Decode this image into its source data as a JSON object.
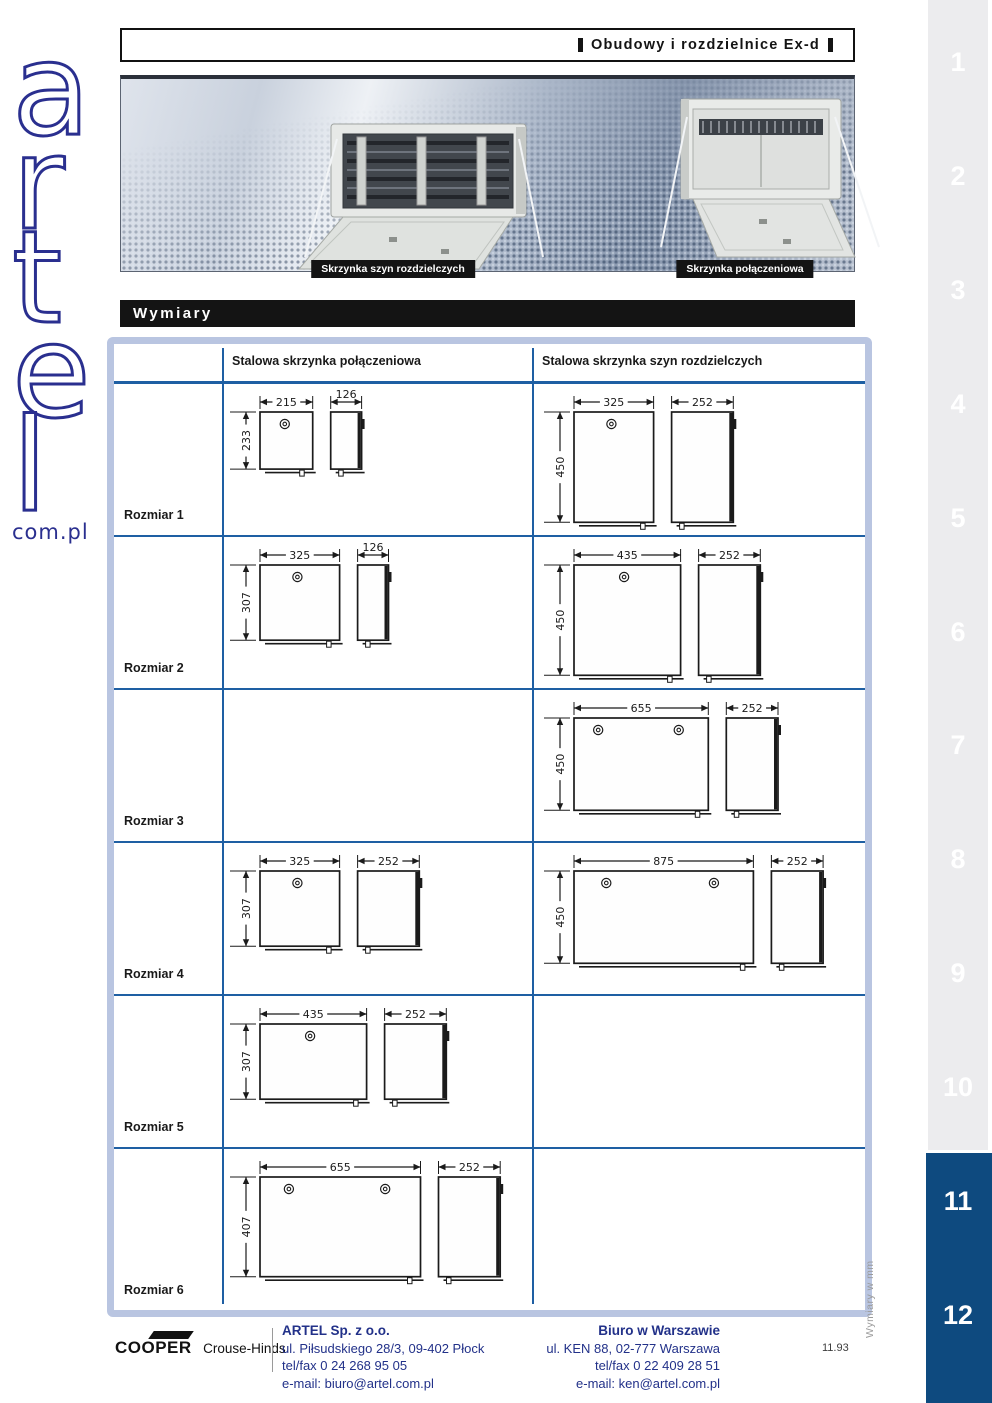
{
  "header": {
    "title": "Obudowy i rozdzielnice Ex-d"
  },
  "logo": {
    "letters": [
      "a",
      "r",
      "t",
      "e",
      "l"
    ],
    "domain": "com.pl"
  },
  "banner": {
    "labels": [
      "Skrzynka szyn rozdzielczych",
      "Skrzynka połączeniowa"
    ]
  },
  "section": {
    "title": "Wymiary"
  },
  "table": {
    "headers": [
      "Stalowa skrzynka połączeniowa",
      "Stalowa skrzynka szyn rozdzielczych"
    ],
    "units_note": "Wymiary w mm",
    "rows": [
      {
        "label": "Rozmiar 1",
        "left": {
          "width": 215,
          "height": 233,
          "depth": 126,
          "locks": 1
        },
        "right": {
          "width": 325,
          "height": 450,
          "depth": 252,
          "locks": 1
        }
      },
      {
        "label": "Rozmiar 2",
        "left": {
          "width": 325,
          "height": 307,
          "depth": 126,
          "locks": 1
        },
        "right": {
          "width": 435,
          "height": 450,
          "depth": 252,
          "locks": 1
        }
      },
      {
        "label": "Rozmiar 3",
        "left": null,
        "right": {
          "width": 655,
          "height": 450,
          "depth": 252,
          "locks": 2
        }
      },
      {
        "label": "Rozmiar 4",
        "left": {
          "width": 325,
          "height": 307,
          "depth": 252,
          "locks": 1
        },
        "right": {
          "width": 875,
          "height": 450,
          "depth": 252,
          "locks": 2
        }
      },
      {
        "label": "Rozmiar 5",
        "left": {
          "width": 435,
          "height": 307,
          "depth": 252,
          "locks": 1
        },
        "right": null
      },
      {
        "label": "Rozmiar 6",
        "left": {
          "width": 655,
          "height": 407,
          "depth": 252,
          "locks": 2
        },
        "right": null
      }
    ]
  },
  "sidebar": {
    "tabs": [
      {
        "label": "1",
        "active": false
      },
      {
        "label": "2",
        "active": false
      },
      {
        "label": "3",
        "active": false
      },
      {
        "label": "4",
        "active": false
      },
      {
        "label": "5",
        "active": false
      },
      {
        "label": "6",
        "active": false
      },
      {
        "label": "7",
        "active": false
      },
      {
        "label": "8",
        "active": false
      },
      {
        "label": "9",
        "active": false
      },
      {
        "label": "10",
        "active": false
      },
      {
        "label": "11",
        "active": true
      },
      {
        "label": "12",
        "active": true
      }
    ]
  },
  "footer": {
    "brand_bold": "COOPER",
    "brand_rest": "Crouse-Hinds",
    "company": {
      "name": "ARTEL Sp. z o.o.",
      "address": "ul. Piłsudskiego 28/3, 09-402 Płock",
      "telfax": "tel/fax 0 24 268 95 05",
      "email": "e-mail: biuro@artel.com.pl"
    },
    "office": {
      "name": "Biuro w Warszawie",
      "address": "ul. KEN 88, 02-777 Warszawa",
      "telfax": "tel/fax 0 22 409 28 51",
      "email": "e-mail: ken@artel.com.pl"
    },
    "page_number": "11.93"
  },
  "colors": {
    "table_frame": "#b9c5e1",
    "table_line": "#1e5fa3",
    "sidebar_active": "#0e4a7f",
    "footer_text": "#223189",
    "bar_black": "#141414",
    "logo_navy": "#2a2f8f"
  }
}
